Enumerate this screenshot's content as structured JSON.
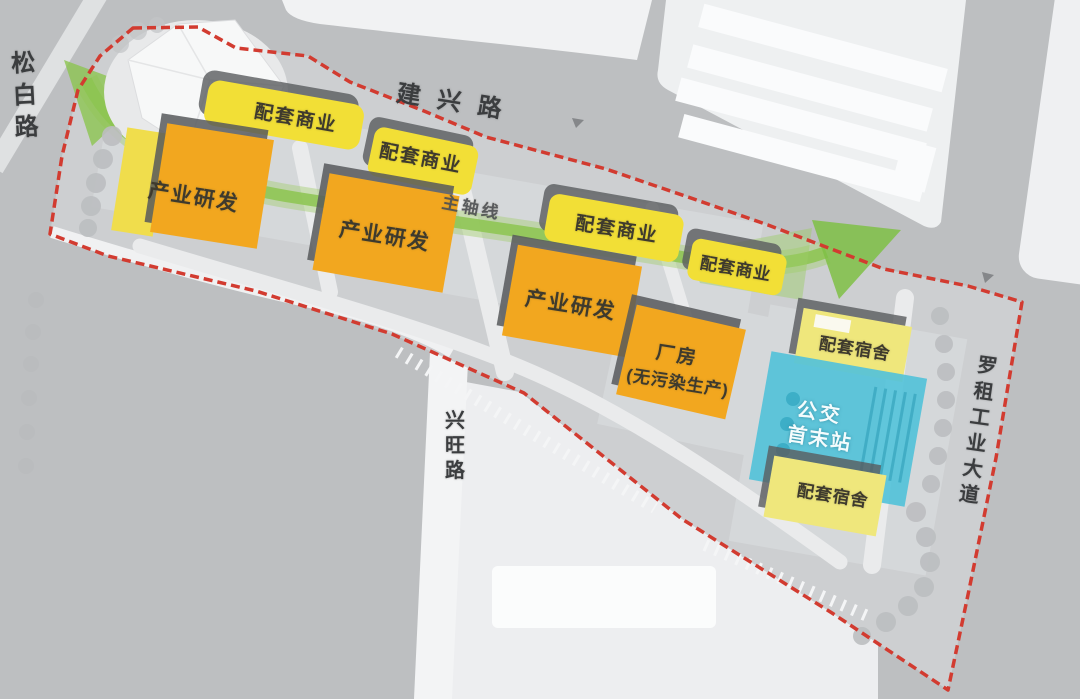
{
  "plan": {
    "type": "site-master-plan",
    "roads": [
      {
        "id": "songbai",
        "label": "松白路"
      },
      {
        "id": "jianxing",
        "label": "建兴路"
      },
      {
        "id": "xingwang",
        "label": "兴旺路"
      },
      {
        "id": "luozu",
        "label": "罗租工业大道"
      }
    ],
    "axis": {
      "label": "主轴线"
    },
    "buildings": [
      {
        "id": "commercial-1",
        "type": "commercial",
        "label": "配套商业"
      },
      {
        "id": "commercial-2",
        "type": "commercial",
        "label": "配套商业"
      },
      {
        "id": "rnd-1",
        "type": "rnd",
        "label": "产业研发"
      },
      {
        "id": "rnd-2",
        "type": "rnd",
        "label": "产业研发"
      },
      {
        "id": "commercial-3",
        "type": "commercial",
        "label": "配套商业"
      },
      {
        "id": "commercial-4",
        "type": "commercial",
        "label": "配套商业"
      },
      {
        "id": "rnd-3",
        "type": "rnd",
        "label": "产业研发"
      },
      {
        "id": "factory-1",
        "type": "factory",
        "label": "厂房",
        "label_line2": "(无污染生产)"
      },
      {
        "id": "dorm-1",
        "type": "dormitory",
        "label": "配套宿舍"
      },
      {
        "id": "bus-terminal",
        "type": "bus-terminal",
        "label": "公交",
        "label_line2": "首末站"
      },
      {
        "id": "dorm-2",
        "type": "dormitory",
        "label": "配套宿舍"
      }
    ],
    "colors": {
      "commercial": "#f2df36",
      "rnd": "#f2a71f",
      "factory": "#f2a71f",
      "dormitory": "#efe77c",
      "bus": "#54c2d9",
      "boundary": "#d23b30",
      "axis_green": "#8cc450"
    }
  }
}
